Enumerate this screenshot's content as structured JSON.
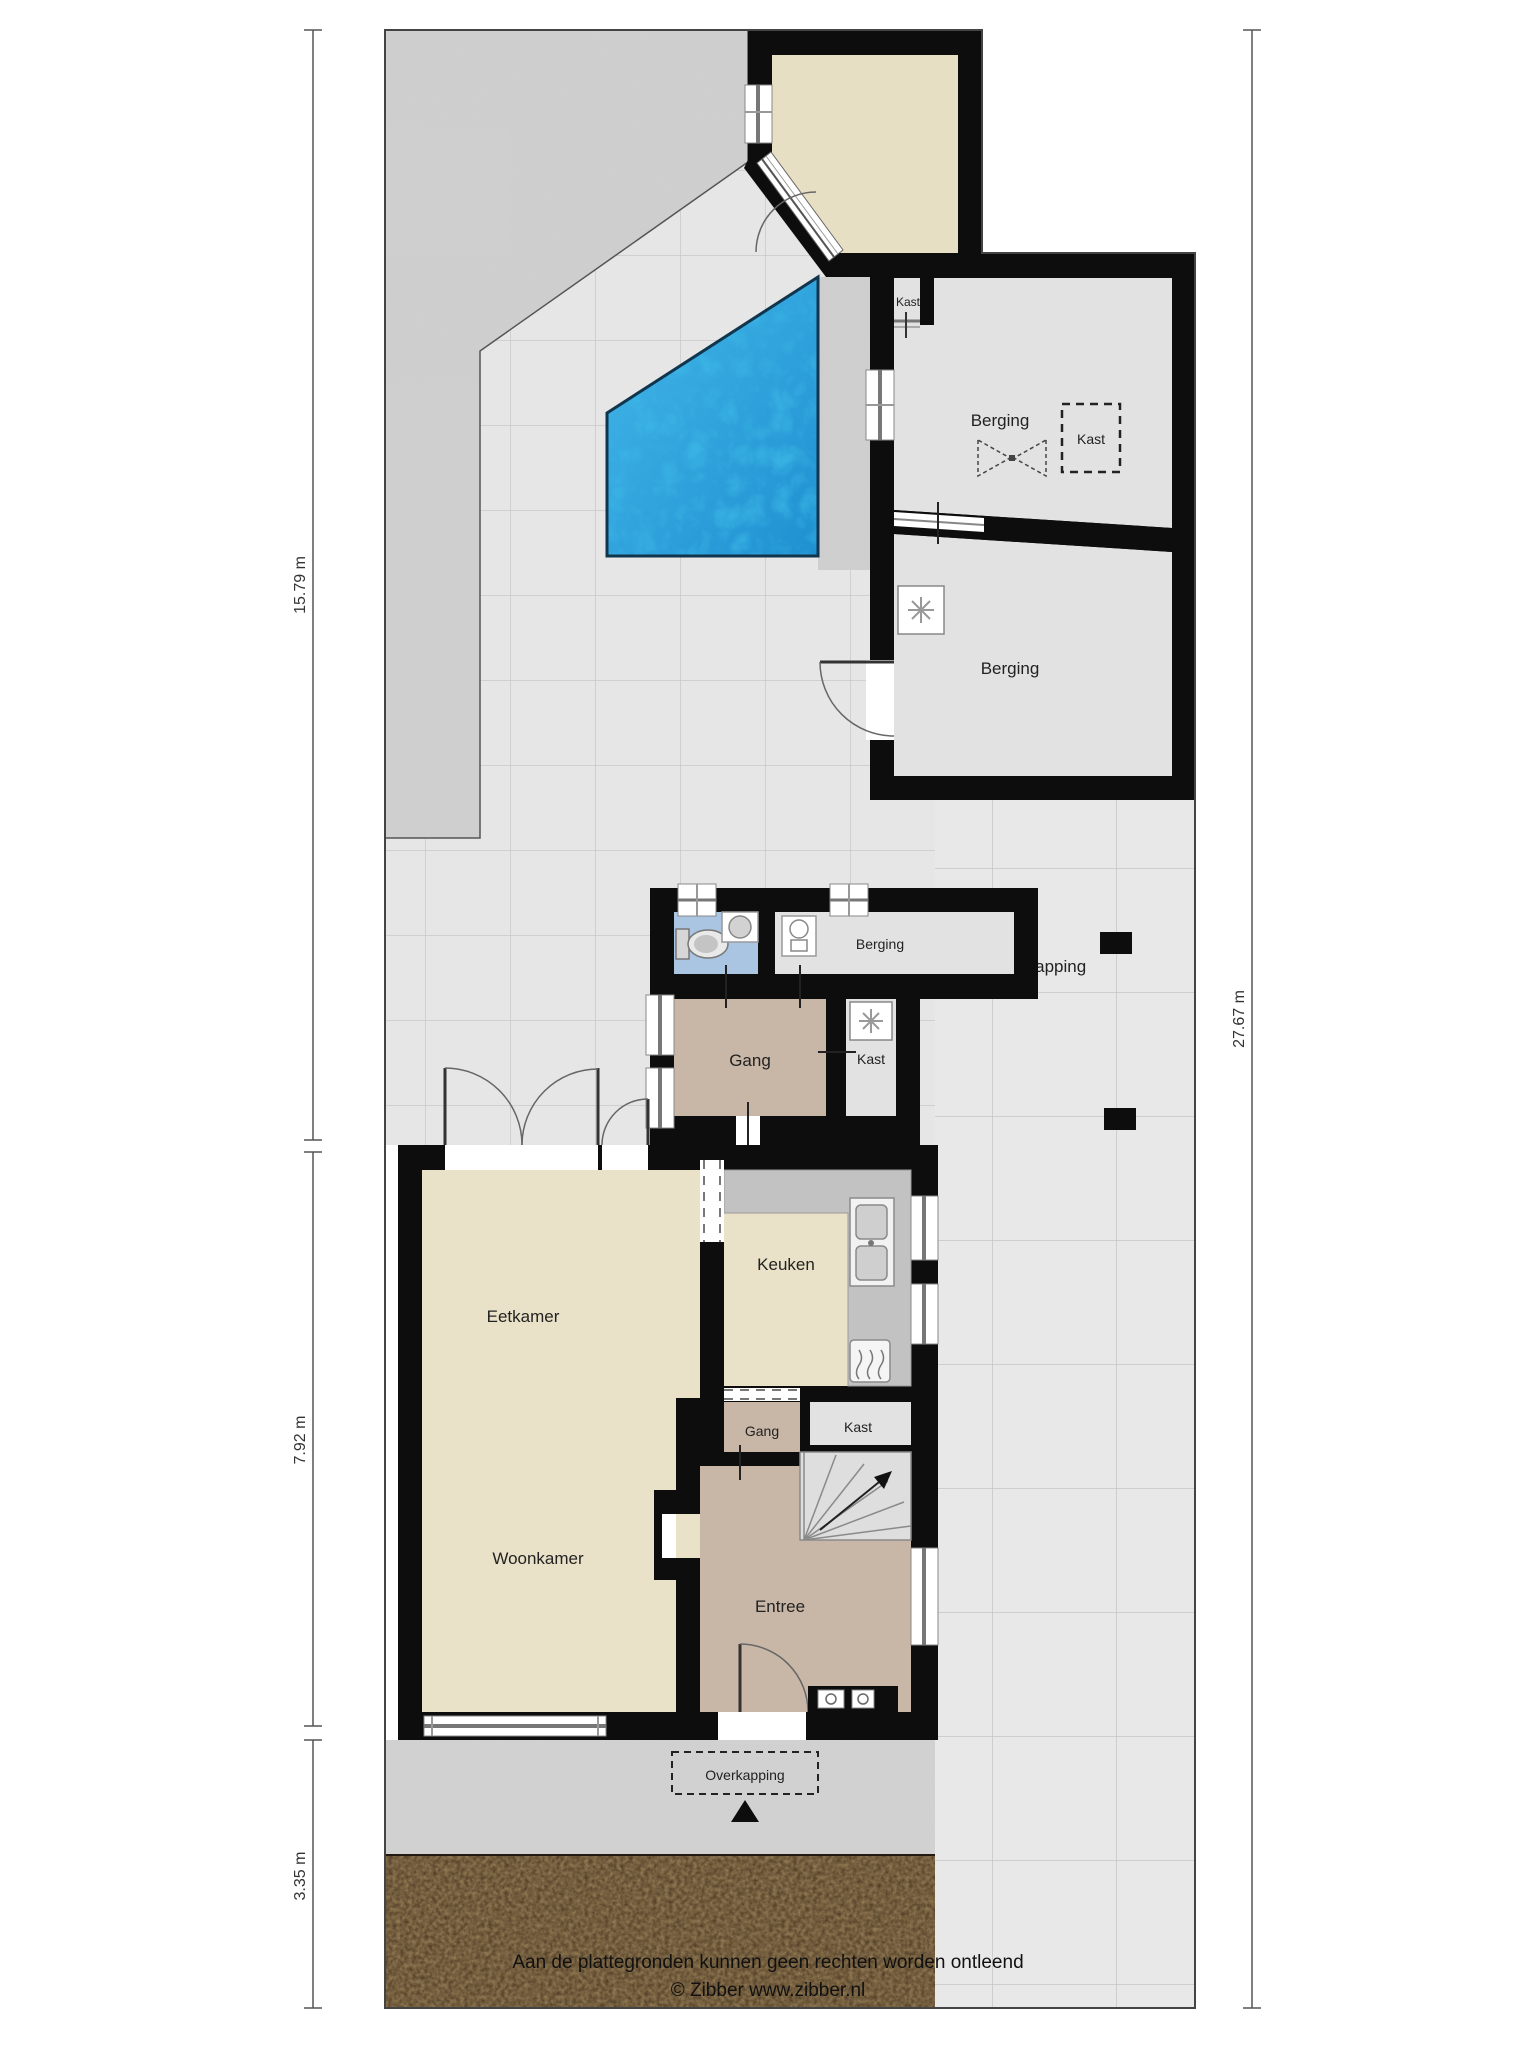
{
  "title": "Floor plan with garden (begane grond met tuin)",
  "labels": {
    "berging_top": "Berging",
    "berging_mid": "Berging",
    "berging_annex": "Berging",
    "kast_closet": "Kast",
    "kast_dashed": "Kast",
    "kast_annex": "Kast",
    "kast_house": "Kast",
    "gang_annex": "Gang",
    "gang_house": "Gang",
    "overkapping_carport": "Overkapping",
    "overkapping_front": "Overkapping",
    "eetkamer": "Eetkamer",
    "keuken": "Keuken",
    "woonkamer": "Woonkamer",
    "entree": "Entree"
  },
  "dimensions": {
    "left": [
      {
        "value": "15.79 m"
      },
      {
        "value": "7.92 m"
      },
      {
        "value": "3.35 m"
      }
    ],
    "right": [
      {
        "value": "27.67 m"
      }
    ]
  },
  "footer": {
    "disclaimer": "Aan de plattegronden kunnen geen rechten worden ontleend",
    "credit": "© Zibber www.zibber.nl"
  },
  "icons": {
    "fan-icon": "asterisk ventilation spokes",
    "toilet-icon": "toilet bowl with cistern",
    "sink-icon": "round corner basin",
    "boiler-icon": "boiler unit",
    "double-sink-icon": "kitchen sink two basins",
    "stove-icon": "cooker with heat squiggles",
    "stairs-up-arrow-icon": "winder stairs with up arrow",
    "entrance-triangle-icon": "black entrance marker triangle",
    "skylight-bowtie-icon": "dashed bow-tie roof light symbol"
  },
  "colors": {
    "wall": "#0d0d0d",
    "pool_water": "#2aa5e3",
    "floor_living": "#eae2c8",
    "floor_storage": "#e2e2e2",
    "floor_hall": "#c8b6a6",
    "floor_toilet": "#a9c5e2",
    "tiles": "#e7e7e7",
    "gravel": "#cccccc",
    "soil": "#4a3826",
    "counter": "#c2c2c2"
  }
}
